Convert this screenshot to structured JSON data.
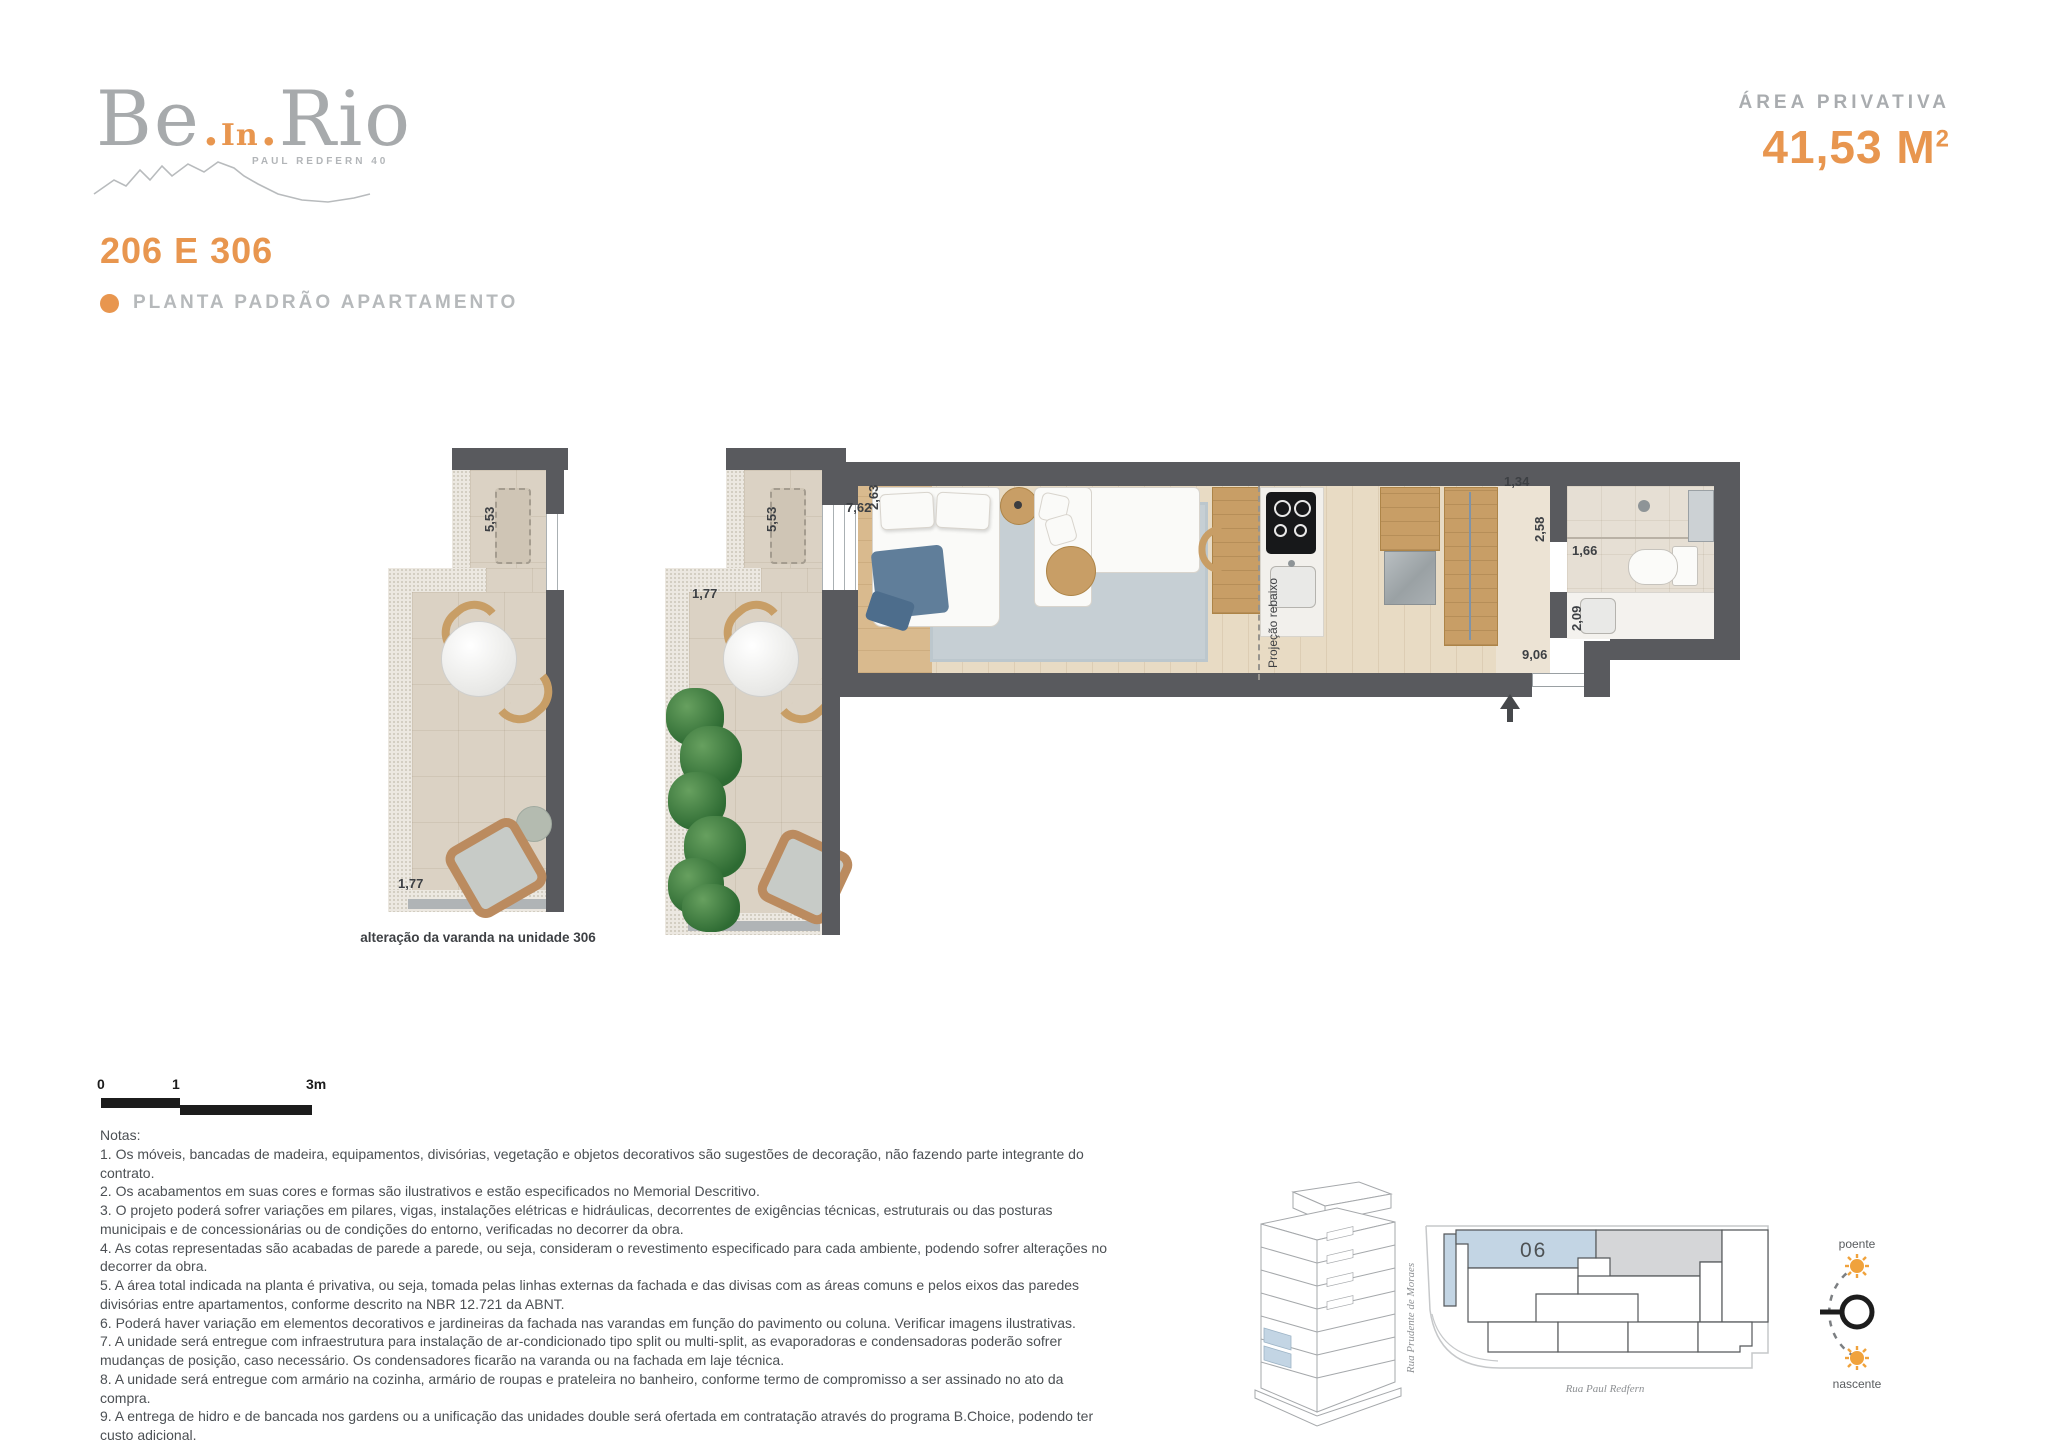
{
  "colors": {
    "accent": "#E8964F",
    "wall": "#595A5E"
  },
  "header": {
    "logo_be": "Be",
    "logo_dot1": ".",
    "logo_in": "In",
    "logo_dot2": ".",
    "logo_rio": "Rio",
    "logo_tagline": "PAUL REDFERN 40",
    "area_label": "ÁREA PRIVATIVA",
    "area_value": "41,53 M",
    "area_sup": "2",
    "unit_title": "206 E 306",
    "plan_label": "PLANTA PADRÃO APARTAMENTO"
  },
  "floorplan": {
    "dims": {
      "balcony306_length": "5,53",
      "balcony306_width": "1,77",
      "balcony_length": "5,53",
      "balcony_width": "1,77",
      "bedroom_length": "7,62",
      "bedroom_width": "2,63",
      "hall_width": "1,34",
      "closet_length": "2,58",
      "bath_length": "1,66",
      "bath_width": "2,09",
      "entry_length": "9,06"
    },
    "labels": {
      "slab_projection": "Projeção rebaixo",
      "variant_caption": "alteração da varanda na unidade 306"
    }
  },
  "scale_bar": {
    "zero": "0",
    "one": "1",
    "three": "3m"
  },
  "notes": {
    "title": "Notas:",
    "items": [
      "1. Os móveis, bancadas de madeira, equipamentos, divisórias, vegetação e objetos decorativos são sugestões de decoração, não fazendo parte integrante do contrato.",
      "2. Os acabamentos em suas cores e formas são ilustrativos e estão especificados no Memorial Descritivo.",
      "3. O projeto poderá sofrer variações em pilares, vigas, instalações elétricas e hidráulicas, decorrentes de exigências técnicas, estruturais ou das posturas municipais e de concessionárias ou de condições do entorno, verificadas no decorrer da obra.",
      "4. As cotas representadas são acabadas de parede a parede, ou seja, consideram o revestimento especificado para cada ambiente, podendo sofrer alterações no decorrer da obra.",
      "5. A área total indicada na planta é privativa, ou seja, tomada pelas linhas externas da fachada e das divisas com as áreas comuns e pelos eixos das paredes divisórias entre apartamentos, conforme descrito na NBR 12.721 da ABNT.",
      "6. Poderá haver variação em elementos decorativos e jardineiras da fachada nas varandas em função do pavimento ou coluna. Verificar imagens ilustrativas.",
      "7. A unidade será entregue com infraestrutura para instalação de ar-condicionado tipo split ou multi-split, as evaporadoras e condensadoras poderão sofrer mudanças de posição, caso necessário. Os condensadores ficarão na varanda ou na fachada em laje técnica.",
      "8. A unidade será entregue com armário na cozinha, armário de roupas e prateleira no banheiro, conforme termo de compromisso a ser assinado no ato da compra.",
      "9. A entrega de hidro e de bancada nos gardens ou a unificação das unidades double será ofertada em contratação através do programa B.Choice, podendo ter custo adicional.",
      "10. O layout é meramente ilustrativo e não será entregue, exceto os móveis planejados que fizerem parte do termo promocional assinado pelo cliente."
    ]
  },
  "key_plan": {
    "unit": "06",
    "street_left": "Rua Prudente de Moraes",
    "street_bottom": "Rua Paul Redfern"
  },
  "compass": {
    "west": "poente",
    "east": "nascente"
  }
}
